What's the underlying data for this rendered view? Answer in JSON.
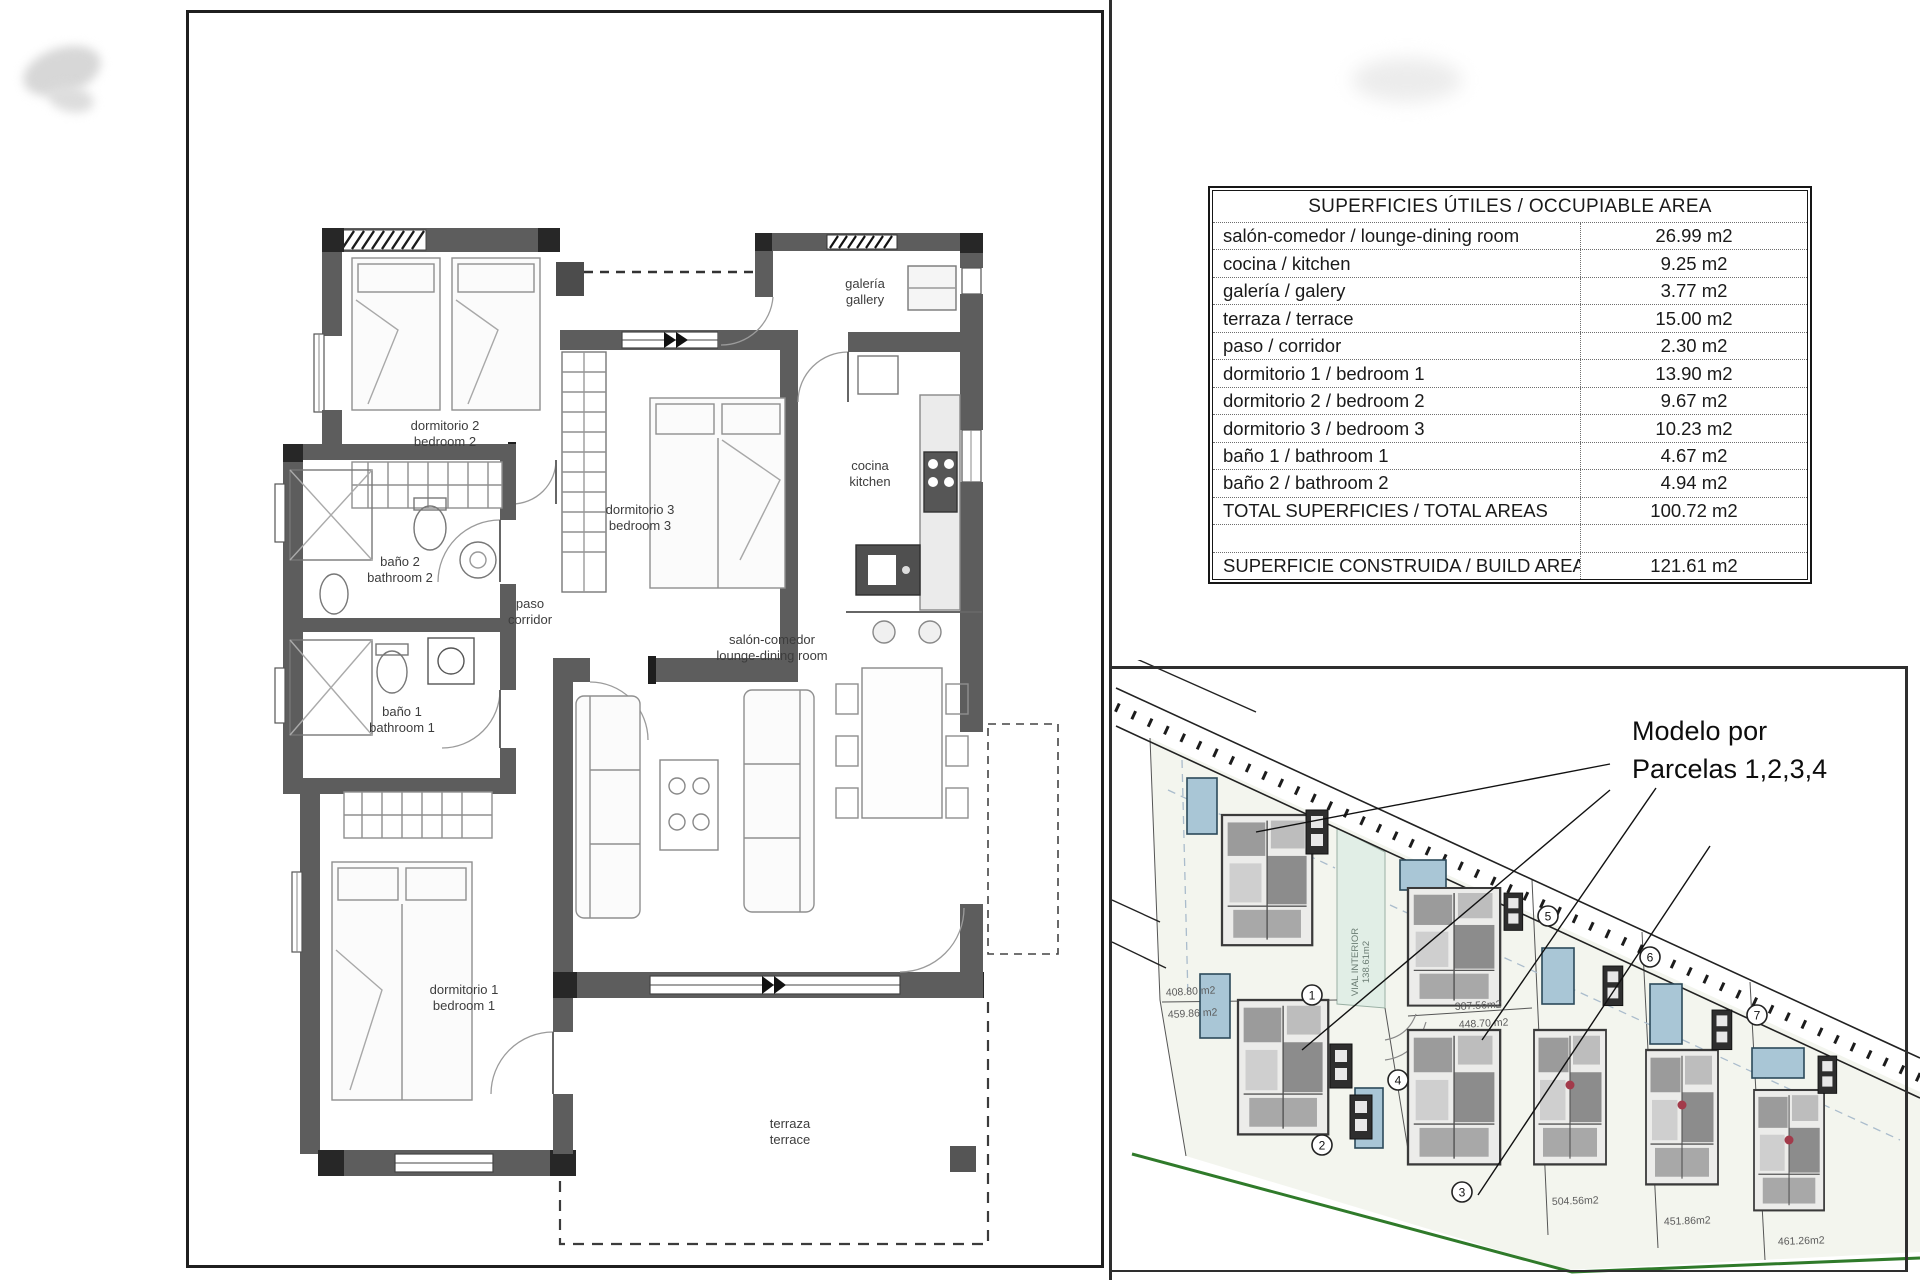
{
  "areas_table": {
    "title": "SUPERFICIES ÚTILES / OCCUPIABLE AREA",
    "rows": [
      {
        "label": "salón-comedor / lounge-dining room",
        "value": "26.99 m2"
      },
      {
        "label": "cocina / kitchen",
        "value": "9.25 m2"
      },
      {
        "label": "galería / galery",
        "value": "3.77 m2"
      },
      {
        "label": "terraza / terrace",
        "value": "15.00 m2"
      },
      {
        "label": "paso / corridor",
        "value": "2.30 m2"
      },
      {
        "label": "dormitorio 1 / bedroom 1",
        "value": "13.90 m2"
      },
      {
        "label": "dormitorio 2 / bedroom 2",
        "value": "9.67 m2"
      },
      {
        "label": "dormitorio 3 / bedroom 3",
        "value": "10.23 m2"
      },
      {
        "label": "baño 1 / bathroom 1",
        "value": "4.67 m2"
      },
      {
        "label": "baño 2 / bathroom 2",
        "value": "4.94 m2"
      }
    ],
    "total": {
      "label": "TOTAL SUPERFICIES / TOTAL AREAS",
      "value": "100.72 m2"
    },
    "build": {
      "label": "SUPERFICIE CONSTRUIDA / BUILD AREA",
      "value": "121.61 m2"
    }
  },
  "plan": {
    "labels": {
      "dorm2": {
        "es": "dormitorio 2",
        "en": "bedroom 2"
      },
      "dorm3": {
        "es": "dormitorio 3",
        "en": "bedroom 3"
      },
      "galeria": {
        "es": "galería",
        "en": "gallery"
      },
      "cocina": {
        "es": "cocina",
        "en": "kitchen"
      },
      "bano2": {
        "es": "baño 2",
        "en": "bathroom 2"
      },
      "paso": {
        "es": "paso",
        "en": "corridor"
      },
      "bano1": {
        "es": "baño 1",
        "en": "bathroom 1"
      },
      "dorm1": {
        "es": "dormitorio 1",
        "en": "bedroom 1"
      },
      "salon": {
        "es": "salón-comedor",
        "en": "lounge-dining room"
      },
      "terraza": {
        "es": "terraza",
        "en": "terrace"
      }
    }
  },
  "site": {
    "annotation": {
      "line1": "Modelo por",
      "line2": "Parcelas 1,2,3,4"
    },
    "vial": {
      "line1": "VIAL INTERIOR",
      "line2": "138.61m2"
    },
    "parcels": [
      {
        "num": "1"
      },
      {
        "num": "2"
      },
      {
        "num": "3"
      },
      {
        "num": "4"
      },
      {
        "num": "5"
      },
      {
        "num": "6"
      },
      {
        "num": "7"
      }
    ],
    "parcel_areas": [
      {
        "text": "408.80 m2"
      },
      {
        "text": "459.86 m2"
      },
      {
        "text": "387.56m2"
      },
      {
        "text": "448.70 m2"
      },
      {
        "text": "504.56m2"
      },
      {
        "text": "451.86m2"
      },
      {
        "text": "461.26m2"
      }
    ],
    "colors": {
      "pool": "#a9c6d6",
      "vial_strip": "#e1eee6",
      "green_boundary": "#2f7a2a",
      "parcel_fill": "#f3f5ee"
    }
  }
}
